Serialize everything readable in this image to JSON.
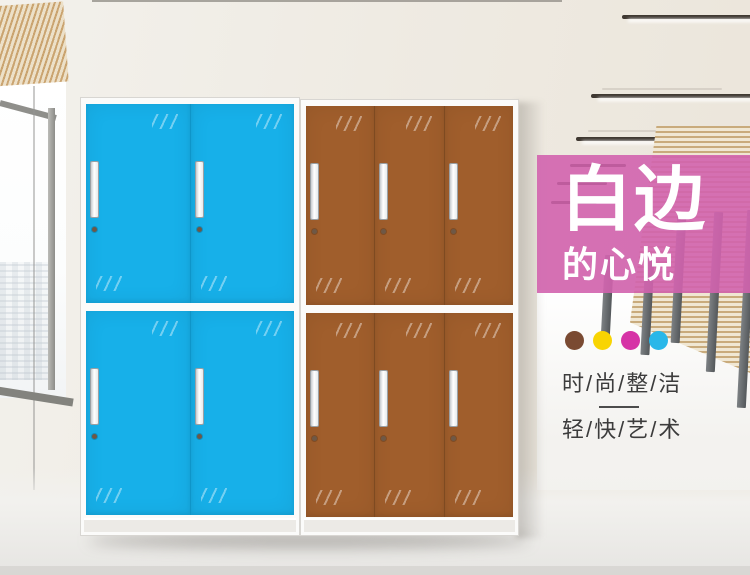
{
  "banner": {
    "title": "白边",
    "subtitle": "的心悦",
    "background_color": "#d263ae"
  },
  "palette_dots": [
    {
      "name": "brown",
      "color": "#7a4a32"
    },
    {
      "name": "yellow",
      "color": "#f8d402"
    },
    {
      "name": "magenta",
      "color": "#d633a6"
    },
    {
      "name": "cyan",
      "color": "#29b7e9"
    }
  ],
  "taglines": {
    "line1": "时/尚/整/洁",
    "line2": "轻/快/艺/术"
  },
  "cabinets": [
    {
      "name": "blue-locker",
      "door_color": "#17b0e9",
      "divider_color": "#0f95c8",
      "columns": 2,
      "rows": 2
    },
    {
      "name": "brown-locker",
      "door_color": "#a05e2c",
      "divider_color": "#7e4a21",
      "columns": 3,
      "rows": 2
    }
  ]
}
